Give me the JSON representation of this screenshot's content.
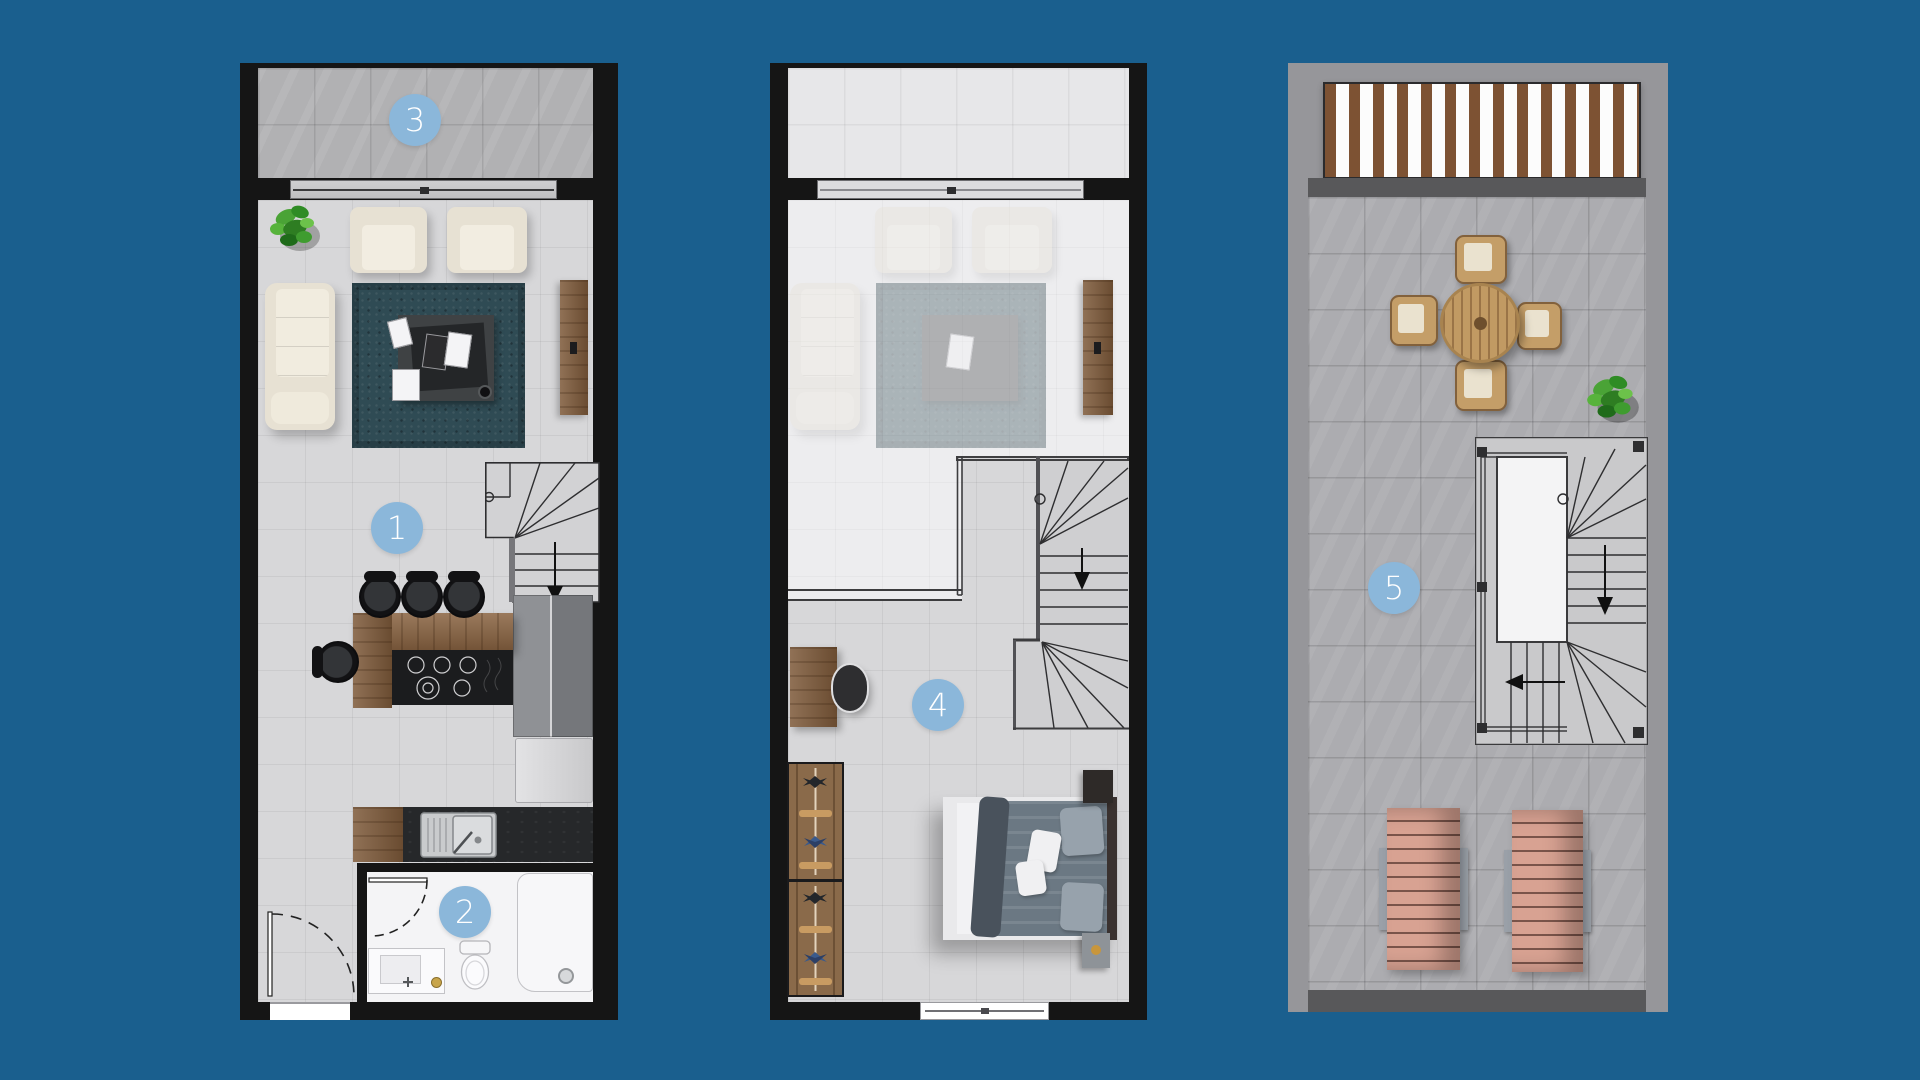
{
  "canvas": {
    "background": "#1A5F8E"
  },
  "badges": {
    "fill": "#8BB7DA",
    "text_color": "#FFFFFF",
    "living_room": "1",
    "bathroom": "2",
    "balcony": "3",
    "bedroom": "4",
    "roof_terrace": "5"
  },
  "palette": {
    "wall_dark": "#151515",
    "wall_gray": "#96969A",
    "terrace_wall_band": "#58585A",
    "floor_light": "#D7D7D9",
    "floor_faded": "#EDEDEF",
    "floor_terrace": "#ACACB0",
    "balcony_tile": "#B1B1B3",
    "bathroom_floor": "#F4F4F6",
    "rug_teal": "#2F4B54",
    "cream_furniture": "#E7E1D3",
    "wood": "#8A6442",
    "counter_dark": "#26282A",
    "bed_blanket": "#6B7883",
    "lounger_pink": "#D8A292",
    "pergola_slat": "#7D5233",
    "plant_green": "#3F9C2F",
    "terrace_wood": "#C19A63"
  }
}
